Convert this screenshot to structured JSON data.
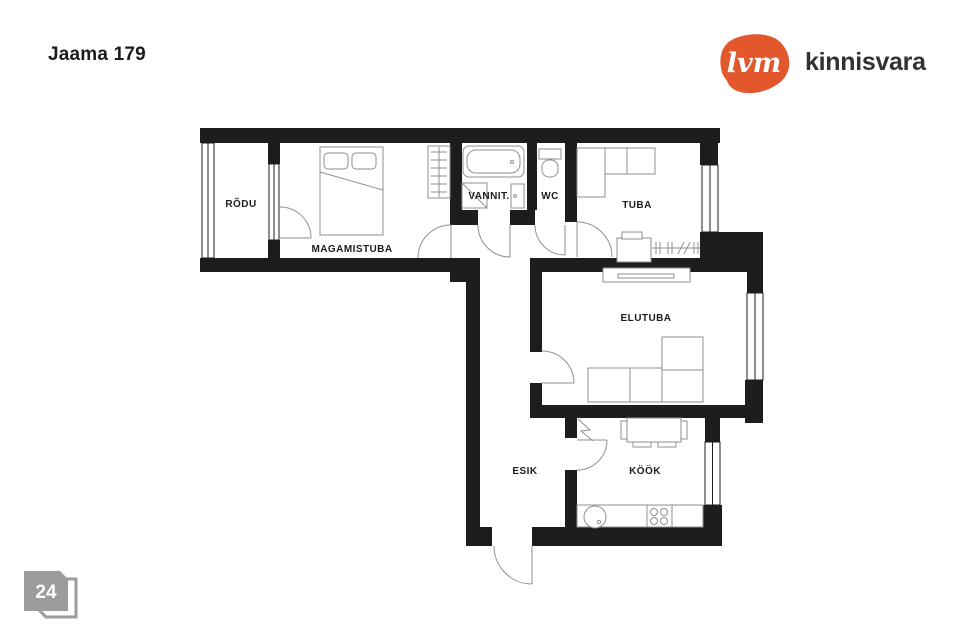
{
  "page": {
    "title": "Jaama 179",
    "page_number": "24",
    "background": "#ffffff",
    "badge_color": "#9c9c9c"
  },
  "brand": {
    "logo_mark": "lvm",
    "logo_text": "kinnisvara",
    "logo_color": "#e2582c",
    "logo_text_color": "#323232"
  },
  "plan": {
    "wall_color": "#1d1d1b",
    "furniture_line_color": "#8f8f8f",
    "rooms": [
      {
        "label": "RÕDU"
      },
      {
        "label": "MAGAMISTUBA"
      },
      {
        "label": "VANNIT."
      },
      {
        "label": "WC"
      },
      {
        "label": "TUBA"
      },
      {
        "label": "ELUTUBA"
      },
      {
        "label": "ESIK"
      },
      {
        "label": "KÖÖK"
      }
    ]
  }
}
